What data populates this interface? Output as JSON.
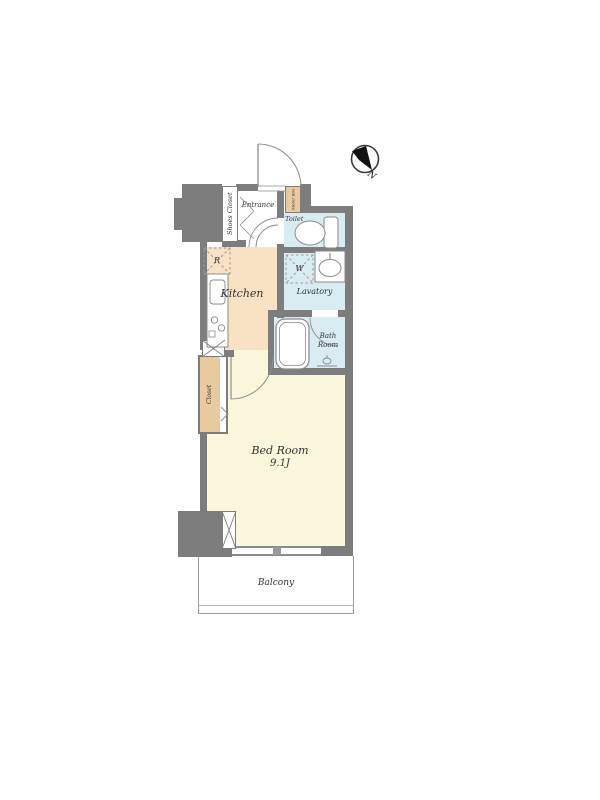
{
  "floorplan": {
    "compass": {
      "north_label": "N"
    },
    "rooms": {
      "entrance": "Entrance",
      "shoes_closet": "Shoes Closet",
      "meter_box": "Meter Box",
      "toilet": "Toilet",
      "kitchen": "Kitchen",
      "lavatory": "Lavatory",
      "bath_room_line1": "Bath",
      "bath_room_line2": "Room",
      "bed_room": "Bed Room",
      "bed_room_size": "9.1J",
      "closet": "Closet",
      "balcony": "Balcony"
    },
    "fixtures": {
      "refrigerator_mark": "R",
      "washing_machine_mark": "W"
    },
    "colors": {
      "wall": "#7d7d7d",
      "kitchen_floor": "#f8e2c3",
      "bedroom_floor": "#fbf7dd",
      "wet_area_floor": "#d9ecf2",
      "closet_fill": "#e9c99e",
      "fixture_stroke": "#8a8a8a",
      "label_text": "#333333"
    }
  }
}
